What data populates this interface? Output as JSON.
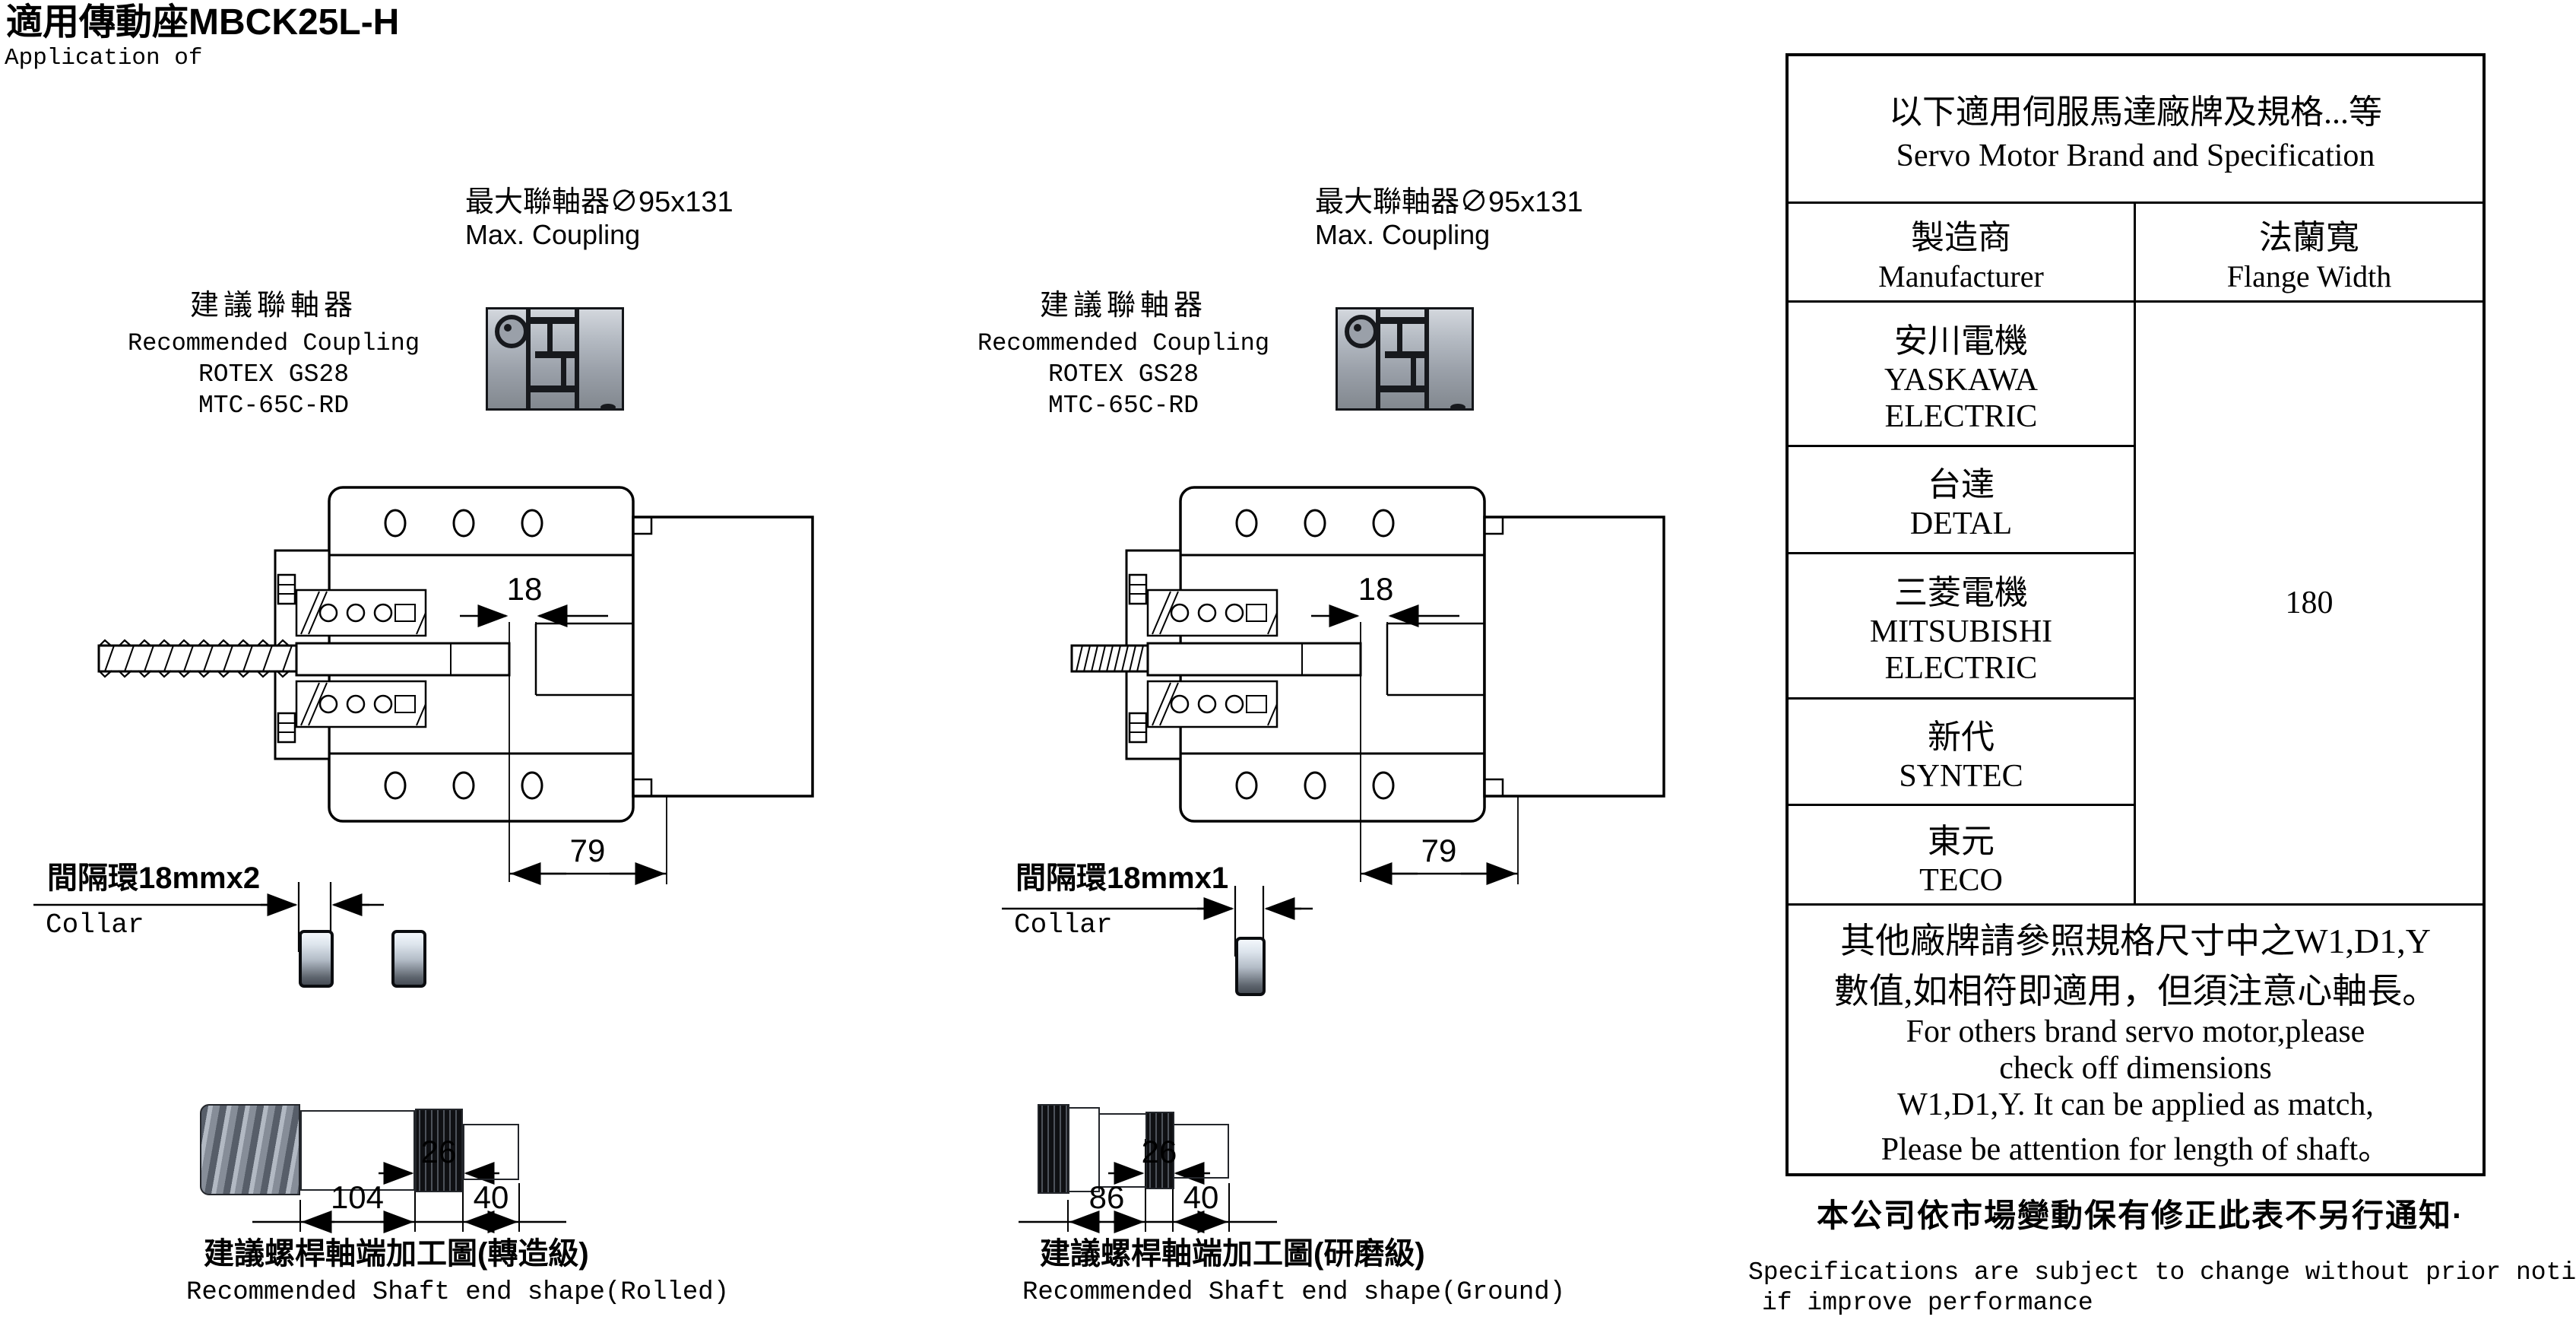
{
  "title": {
    "zh": "適用傳動座MBCK25L-H",
    "en": "Application of"
  },
  "columns": [
    {
      "max_coupling_zh": "最大聯軸器∅95x131",
      "max_coupling_en": "Max. Coupling",
      "rec_zh": "建議聯軸器",
      "rec_en": "Recommended Coupling",
      "rec_model1": "ROTEX GS28",
      "rec_model2": "MTC-65C-RD",
      "dim_gap": "18",
      "dim_width": "79",
      "collar_zh": "間隔環18mmx2",
      "collar_en": "Collar",
      "shaft_dim_mid": "26",
      "shaft_dim_main": "104",
      "shaft_dim_end": "40",
      "caption_zh": "建議螺桿軸端加工圖(轉造級)",
      "caption_en": "Recommended Shaft end shape(Rolled)"
    },
    {
      "max_coupling_zh": "最大聯軸器∅95x131",
      "max_coupling_en": "Max. Coupling",
      "rec_zh": "建議聯軸器",
      "rec_en": "Recommended Coupling",
      "rec_model1": "ROTEX GS28",
      "rec_model2": "MTC-65C-RD",
      "dim_gap": "18",
      "dim_width": "79",
      "collar_zh": "間隔環18mmx1",
      "collar_en": "Collar",
      "shaft_dim_mid": "26",
      "shaft_dim_main": "86",
      "shaft_dim_end": "40",
      "caption_zh": "建議螺桿軸端加工圖(研磨級)",
      "caption_en": "Recommended Shaft end shape(Ground)"
    }
  ],
  "table": {
    "title_zh": "以下適用伺服馬達廠牌及規格...等",
    "title_en": "Servo Motor Brand and Specification",
    "col_manufacturer_zh": "製造商",
    "col_manufacturer_en": "Manufacturer",
    "col_flange_zh": "法蘭寬",
    "col_flange_en": "Flange Width",
    "rows": [
      {
        "zh": "安川電機",
        "en": "YASKAWA ELECTRIC"
      },
      {
        "zh": "台達",
        "en": "DETAL"
      },
      {
        "zh": "三菱電機",
        "en": "MITSUBISHI ELECTRIC"
      },
      {
        "zh": "新代",
        "en": "SYNTEC"
      },
      {
        "zh": "東元",
        "en": "TECO"
      }
    ],
    "flange_width_value": "180",
    "note_zh1": "其他廠牌請參照規格尺寸中之W1,D1,Y",
    "note_zh2": "數值,如相符即適用，但須注意心軸長。",
    "note_en1": "For others brand servo motor,please",
    "note_en2": "check off dimensions",
    "note_en3": "W1,D1,Y. It can be applied as match,",
    "note_en4": "Please be attention for length of shaft。"
  },
  "footer": {
    "zh": "本公司依市場變動保有修正此表不另行通知·",
    "en1": "Specifications are subject to change without prior notice",
    "en2": "if improve performance"
  }
}
